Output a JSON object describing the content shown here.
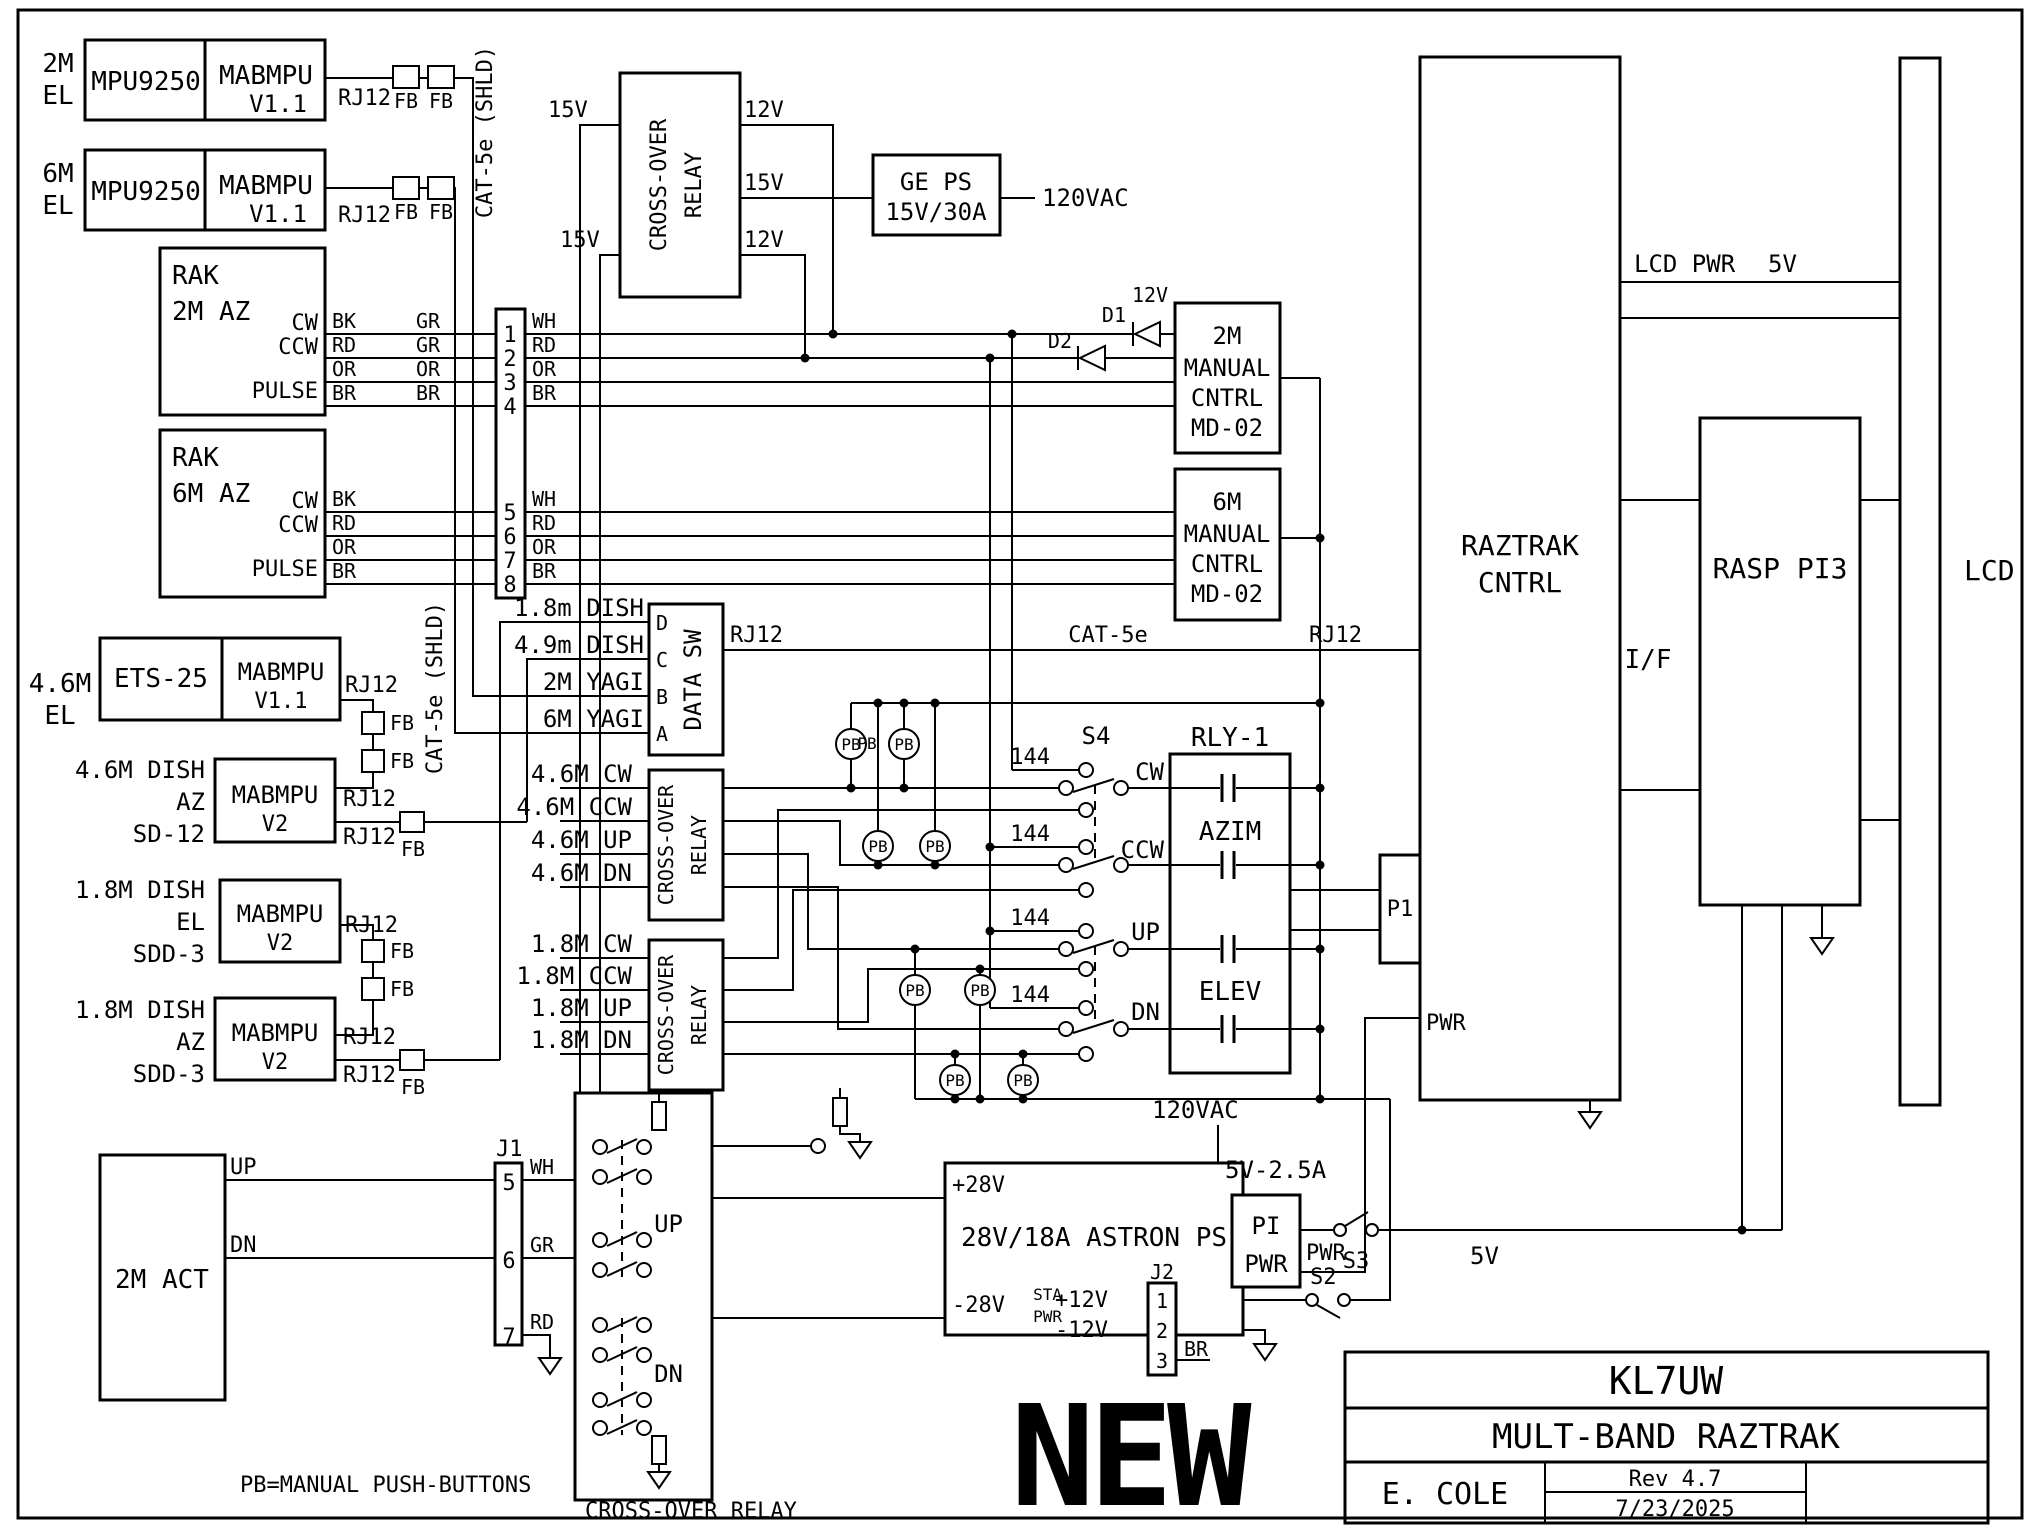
{
  "w": {
    "bk": "BK",
    "rd": "RD",
    "or": "OR",
    "br": "BR",
    "gr": "GR",
    "wh": "WH"
  },
  "v": {
    "v15": "15V",
    "v12": "12V",
    "v5": "5V",
    "v120": "120VAC",
    "v52": "5V-2.5A",
    "p28": "+28V",
    "n28": "-28V",
    "p12": "+12V",
    "n12": "-12V"
  },
  "c": {
    "rj12": "RJ12",
    "fb": "FB",
    "cat5s": "CAT-5e (SHLD)",
    "cat5": "CAT-5e",
    "xover1": "CROSS-OVER",
    "xover2": "RELAY",
    "xoverh": "CROSS-OVER RELAY",
    "datasw": "DATA SW",
    "pb": "PB",
    "f144": "144"
  },
  "sens": {
    "b2m": "2M",
    "b6m": "6M",
    "el": "EL",
    "mpu": "MPU9250",
    "mab": "MABMPU",
    "v11": "V1.1",
    "v2": "V2",
    "ets": "ETS-25"
  },
  "rak": {
    "name": "RAK",
    "az2": "2M AZ",
    "az6": "6M AZ",
    "cw": "CW",
    "ccw": "CCW",
    "pulse": "PULSE"
  },
  "pins": [
    "1",
    "2",
    "3",
    "4",
    "5",
    "6",
    "7",
    "8"
  ],
  "ge": {
    "l1": "GE PS",
    "l2": "15V/30A"
  },
  "d": {
    "d1": "D1",
    "d2": "D2"
  },
  "md": {
    "m2": "2M",
    "m6": "6M",
    "l2": "MANUAL",
    "l3": "CNTRL",
    "l4": "MD-02"
  },
  "dsw": {
    "d": "1.8m DISH",
    "c": "4.9m DISH",
    "b": "2M YAGI",
    "a": "6M YAGI",
    "pd": "D",
    "pc": "C",
    "pb": "B",
    "pa": "A"
  },
  "dish": {
    "el46": "4.6M",
    "el": "EL",
    "d46": "4.6M DISH",
    "az": "AZ",
    "sd12": "SD-12",
    "d18": "1.8M DISH",
    "elw": "EL",
    "sdd3": "SDD-3"
  },
  "mid": {
    "s4": "S4",
    "cw": "CW",
    "ccw": "CCW",
    "up": "UP",
    "dn": "DN",
    "rly": "RLY-1",
    "azim": "AZIM",
    "elev": "ELEV",
    "r46": [
      "4.6M CW",
      "4.6M CCW",
      "4.6M UP",
      "4.6M DN"
    ],
    "r18": [
      "1.8M CW",
      "1.8M CCW",
      "1.8M UP",
      "1.8M DN"
    ]
  },
  "rt": {
    "rz1": "RAZTRAK",
    "rz2": "CNTRL",
    "iface": "I/F",
    "lcdpwr": "LCD PWR",
    "rasp": "RASP PI3",
    "lcd": "LCD",
    "p1": "P1",
    "pwr": "PWR"
  },
  "bt": {
    "act": "2M ACT",
    "j1": "J1",
    "j2": "J2",
    "sta": "STA",
    "pwr": "PWR",
    "s2": "S2",
    "s3": "S3",
    "pi1": "PI",
    "pi2": "PWR",
    "astron": "28V/18A ASTRON PS",
    "br": "BR",
    "up": "UP",
    "dn": "DN"
  },
  "tb": {
    "callsign": "KL7UW",
    "title": "MULT-BAND RAZTRAK",
    "author": "E. COLE",
    "rev": "Rev 4.7",
    "date": "7/23/2025"
  },
  "stamp": "NEW",
  "note": "PB=MANUAL PUSH-BUTTONS"
}
